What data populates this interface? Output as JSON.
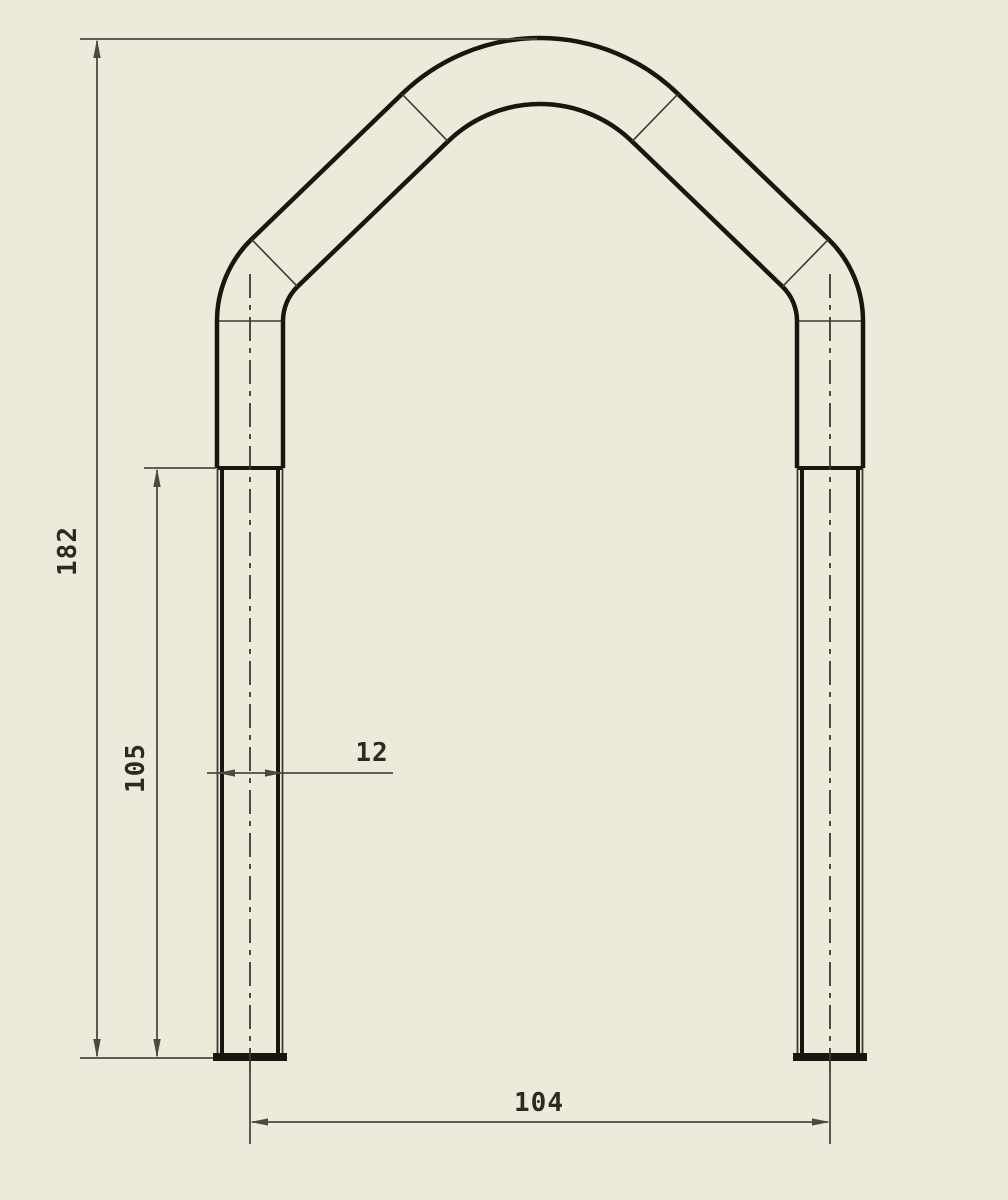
{
  "drawing": {
    "type": "cad-orthographic-view",
    "part": "u-bolt",
    "dimensions": {
      "overall_height": "182",
      "thread_length": "105",
      "rod_diameter": "12",
      "leg_spacing": "104"
    }
  },
  "colors": {
    "background": "#ecebdb",
    "outline": "#17170f",
    "thin_line": "#3a3a30",
    "dimension": "#4a4a40",
    "text": "#2b2b22"
  }
}
